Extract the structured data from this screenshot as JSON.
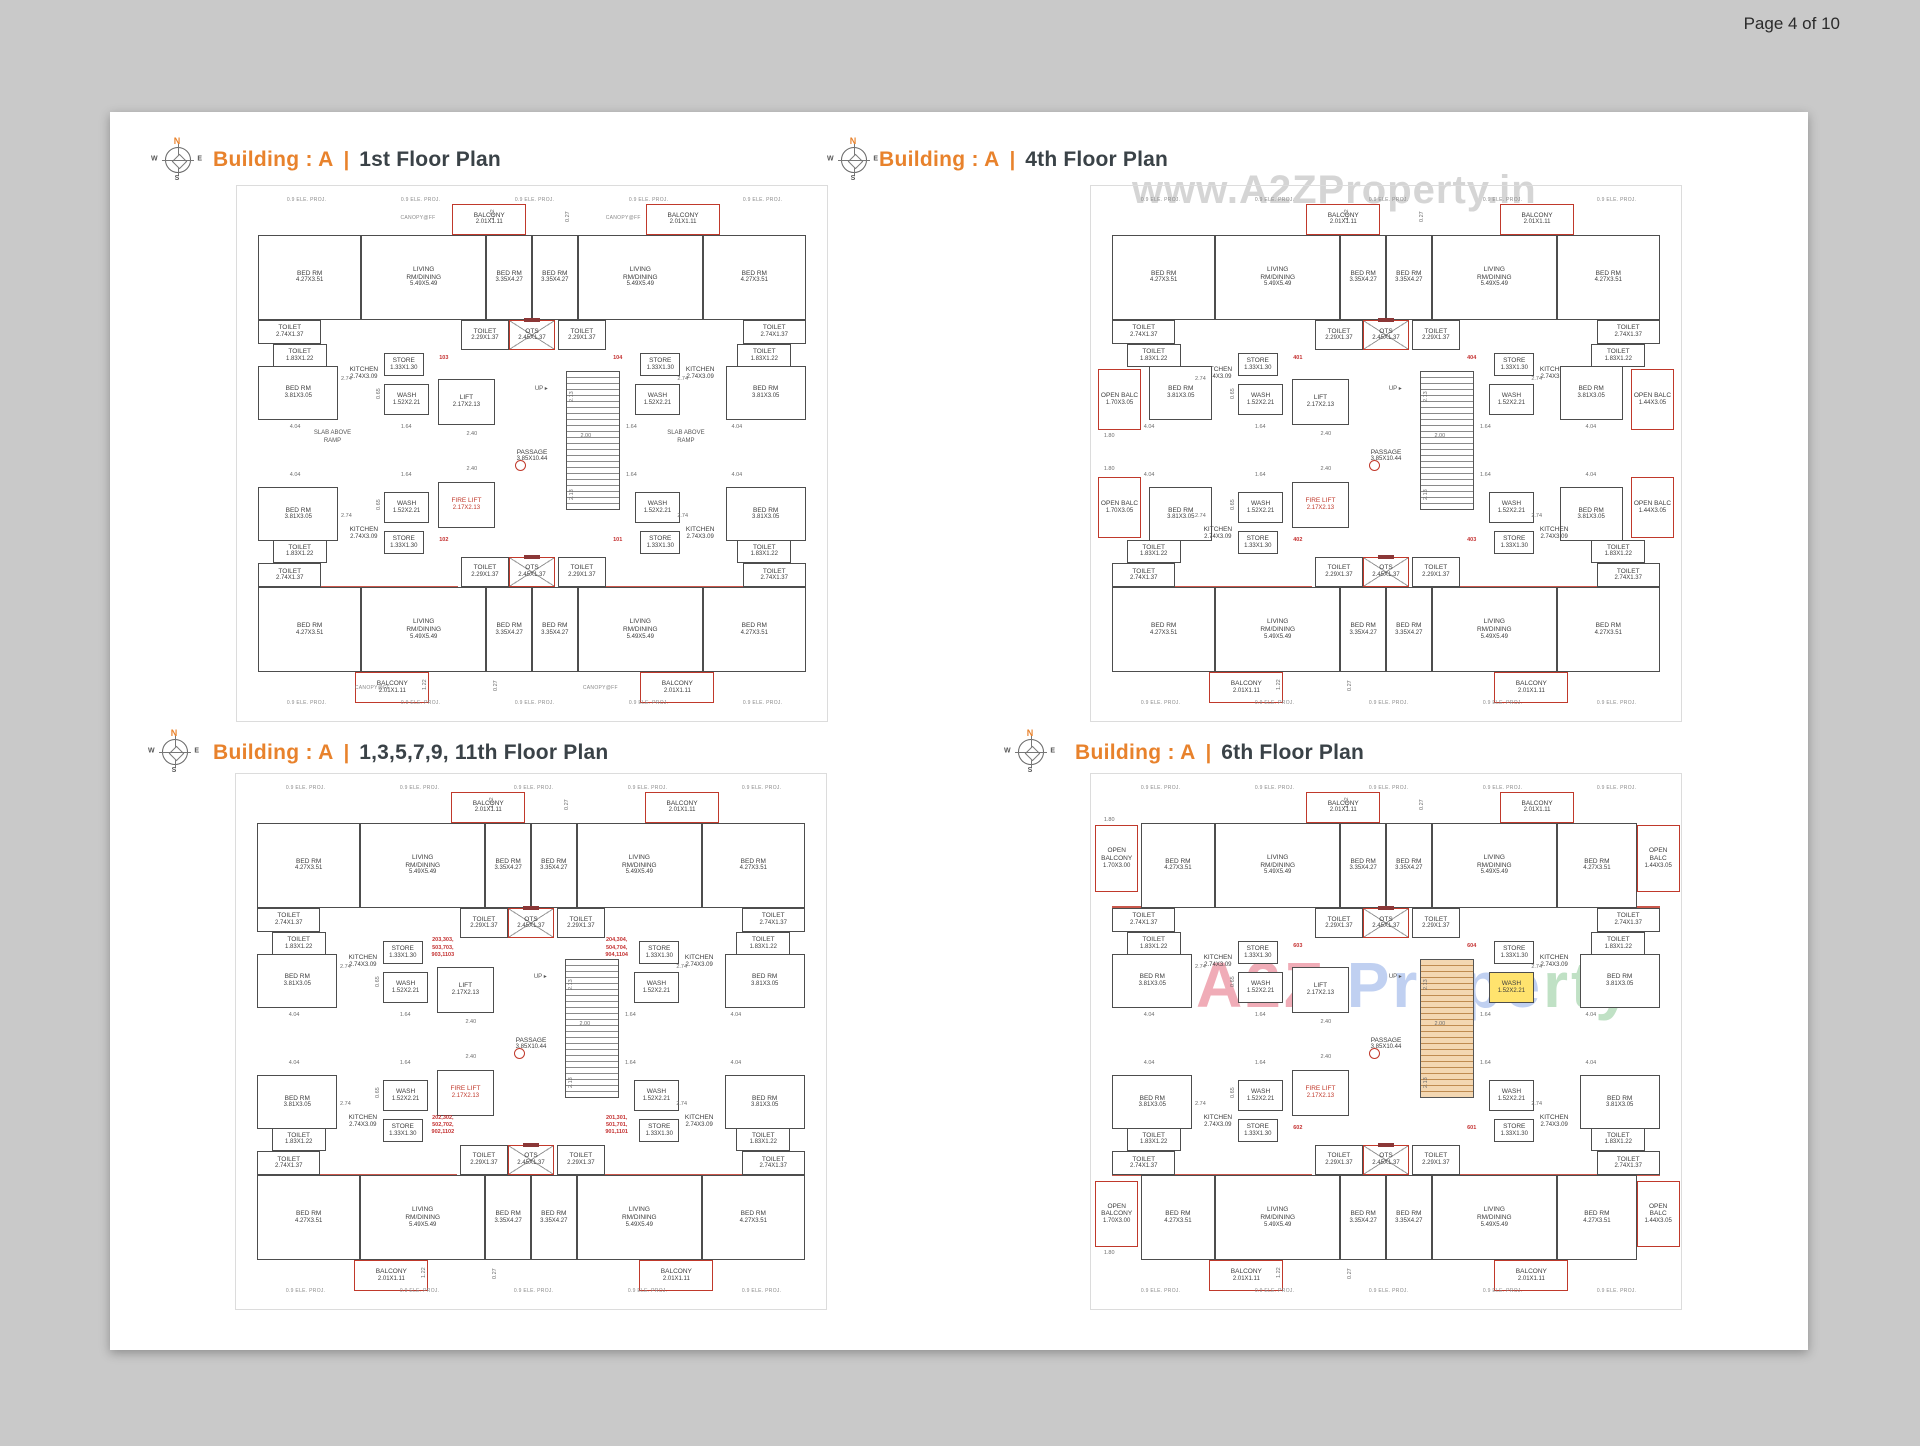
{
  "page": {
    "number_label": "Page 4 of 10"
  },
  "compass": {
    "n": "N",
    "e": "E",
    "s": "S",
    "w": "W"
  },
  "watermark_top": "www.A2ZProperty.in",
  "watermark_brand": {
    "a2z": "A2Z ",
    "prope": "Prope",
    "rty": "rty"
  },
  "shared": {
    "proj_label": "0.9 ELE. PROJ.",
    "proj_positions": [
      [
        7,
        0.2
      ],
      [
        27,
        0.2
      ],
      [
        47,
        0.2
      ],
      [
        67,
        0.2
      ],
      [
        87,
        0.2
      ],
      [
        7,
        97.9
      ],
      [
        27,
        97.9
      ],
      [
        47,
        97.9
      ],
      [
        67,
        97.9
      ],
      [
        87,
        97.9
      ]
    ],
    "up_label": "UP ▸",
    "up_pos": [
      50.5,
      36.8
    ],
    "markers": [
      [
        47,
        51.2
      ]
    ],
    "red_walls": [
      [
        2,
        23.6,
        35
      ],
      [
        63,
        23.6,
        35
      ],
      [
        2,
        75.7,
        35
      ],
      [
        63,
        75.7,
        35
      ]
    ],
    "dims": [
      {
        "t": "2.74",
        "x": 16.5,
        "y": 34.9
      },
      {
        "t": "2.74",
        "x": 75.5,
        "y": 34.9
      },
      {
        "t": "2.74",
        "x": 16.5,
        "y": 61.6
      },
      {
        "t": "2.74",
        "x": 75.5,
        "y": 61.6
      },
      {
        "t": "1.64",
        "x": 27,
        "y": 44.3
      },
      {
        "t": "1.64",
        "x": 66.5,
        "y": 44.3
      },
      {
        "t": "1.64",
        "x": 27,
        "y": 53.6
      },
      {
        "t": "1.64",
        "x": 66.5,
        "y": 53.6
      },
      {
        "t": "2.40",
        "x": 38.5,
        "y": 45.6
      },
      {
        "t": "2.40",
        "x": 38.5,
        "y": 52.4
      },
      {
        "t": "2.00",
        "x": 58.5,
        "y": 46
      },
      {
        "t": "4.04",
        "x": 7.5,
        "y": 44.3
      },
      {
        "t": "4.04",
        "x": 85,
        "y": 44.3
      },
      {
        "t": "4.04",
        "x": 7.5,
        "y": 53.6
      },
      {
        "t": "4.04",
        "x": 85,
        "y": 53.6
      },
      {
        "t": "2.13",
        "x": 56.5,
        "y": 40,
        "v": 1
      },
      {
        "t": "2.13",
        "x": 56.5,
        "y": 59,
        "v": 1
      },
      {
        "t": "1.22",
        "x": 42.7,
        "y": 4.6,
        "v": 1
      },
      {
        "t": "1.22",
        "x": 30.7,
        "y": 96,
        "v": 1
      },
      {
        "t": "0.27",
        "x": 55.8,
        "y": 5,
        "v": 1
      },
      {
        "t": "0.27",
        "x": 43.2,
        "y": 96.2,
        "v": 1
      },
      {
        "t": "0.65",
        "x": 22.6,
        "y": 39.5,
        "v": 1
      },
      {
        "t": "0.65",
        "x": 22.6,
        "y": 61,
        "v": 1
      }
    ]
  },
  "base_rooms": [
    {
      "id": "balc_t1",
      "label": "BALCONY",
      "dim": "2.01X1.11",
      "x": 36,
      "y": 1.5,
      "w": 13,
      "h": 6,
      "cls": "red"
    },
    {
      "id": "balc_t2",
      "label": "BALCONY",
      "dim": "2.01X1.11",
      "x": 70,
      "y": 1.5,
      "w": 13,
      "h": 6,
      "cls": "red"
    },
    {
      "id": "bed_tl",
      "label": "BED RM",
      "dim": "4.27X3.51",
      "x": 2,
      "y": 7.5,
      "w": 18,
      "h": 16.5
    },
    {
      "id": "liv_tl",
      "label": "LIVING\nRM/DINING",
      "dim": "5.49X5.49",
      "x": 20,
      "y": 7.5,
      "w": 22,
      "h": 16.5
    },
    {
      "id": "bed_tm1",
      "label": "BED RM",
      "dim": "3.35X4.27",
      "x": 42,
      "y": 7.5,
      "w": 8,
      "h": 16.5
    },
    {
      "id": "bed_tm2",
      "label": "BED RM",
      "dim": "3.35X4.27",
      "x": 50,
      "y": 7.5,
      "w": 8,
      "h": 16.5
    },
    {
      "id": "liv_tr",
      "label": "LIVING\nRM/DINING",
      "dim": "5.49X5.49",
      "x": 58,
      "y": 7.5,
      "w": 22,
      "h": 16.5
    },
    {
      "id": "bed_tr",
      "label": "BED RM",
      "dim": "4.27X3.51",
      "x": 80,
      "y": 7.5,
      "w": 18,
      "h": 16.5
    },
    {
      "id": "wc_tl1",
      "label": "TOILET",
      "dim": "2.74X1.37",
      "x": 2,
      "y": 24,
      "w": 11,
      "h": 4.8
    },
    {
      "id": "wc_tl2",
      "label": "TOILET",
      "dim": "1.83X1.22",
      "x": 4.5,
      "y": 28.8,
      "w": 9.5,
      "h": 4.5
    },
    {
      "id": "wc_ct1",
      "label": "TOILET",
      "dim": "2.29X1.37",
      "x": 37.5,
      "y": 24,
      "w": 8.5,
      "h": 6
    },
    {
      "id": "ots_t",
      "label": "OTS",
      "dim": "2.45X1.37",
      "x": 46,
      "y": 24,
      "w": 8,
      "h": 6,
      "cls": "ots"
    },
    {
      "id": "wc_ct2",
      "label": "TOILET",
      "dim": "2.29X1.37",
      "x": 54.5,
      "y": 24,
      "w": 8.5,
      "h": 6
    },
    {
      "id": "wc_tr2",
      "label": "TOILET",
      "dim": "1.83X1.22",
      "x": 86,
      "y": 28.8,
      "w": 9.5,
      "h": 4.5
    },
    {
      "id": "wc_tr1",
      "label": "TOILET",
      "dim": "2.74X1.37",
      "x": 87,
      "y": 24,
      "w": 11,
      "h": 4.8
    },
    {
      "id": "store_tl",
      "label": "STORE",
      "dim": "1.33X1.30",
      "x": 24,
      "y": 30.5,
      "w": 7,
      "h": 4.5
    },
    {
      "id": "store_tr",
      "label": "STORE",
      "dim": "1.33X1.30",
      "x": 69,
      "y": 30.5,
      "w": 7,
      "h": 4.5
    },
    {
      "id": "kit_tl",
      "label": "KITCHEN",
      "dim": "2.74X3.09",
      "x": 15.5,
      "y": 31.5,
      "w": 10,
      "h": 6,
      "cls": "open"
    },
    {
      "id": "kit_tr",
      "label": "KITCHEN",
      "dim": "2.74X3.09",
      "x": 74.5,
      "y": 31.5,
      "w": 10,
      "h": 6,
      "cls": "open"
    },
    {
      "id": "bed_ml",
      "label": "BED RM",
      "dim": "3.81X3.05",
      "x": 2,
      "y": 33,
      "w": 14,
      "h": 10.5
    },
    {
      "id": "bed_mr",
      "label": "BED RM",
      "dim": "3.81X3.05",
      "x": 84,
      "y": 33,
      "w": 14,
      "h": 10.5
    },
    {
      "id": "wash_tl",
      "label": "WASH",
      "dim": "1.52X2.21",
      "x": 24,
      "y": 36.5,
      "w": 8,
      "h": 6
    },
    {
      "id": "wash_tr",
      "label": "WASH",
      "dim": "1.52X2.21",
      "x": 68,
      "y": 36.5,
      "w": 8,
      "h": 6
    },
    {
      "id": "lift",
      "label": "LIFT",
      "dim": "2.17X2.13",
      "x": 33.5,
      "y": 35.5,
      "w": 10,
      "h": 9
    },
    {
      "id": "stairs",
      "label": "",
      "dim": "",
      "x": 56,
      "y": 34,
      "w": 9.5,
      "h": 27,
      "cls": "stairs"
    },
    {
      "id": "passage",
      "label": "PASSAGE",
      "dim": "3.85X10.44",
      "x": 44,
      "y": 47,
      "w": 12,
      "h": 7,
      "cls": "open"
    },
    {
      "id": "firelift",
      "label": "FIRE LIFT",
      "dim": "2.17X2.13",
      "x": 33.5,
      "y": 55.5,
      "w": 10,
      "h": 9,
      "cls": "redtext"
    },
    {
      "id": "wash_bl",
      "label": "WASH",
      "dim": "1.52X2.21",
      "x": 24,
      "y": 57.5,
      "w": 8,
      "h": 6
    },
    {
      "id": "wash_br",
      "label": "WASH",
      "dim": "1.52X2.21",
      "x": 68,
      "y": 57.5,
      "w": 8,
      "h": 6
    },
    {
      "id": "bed_ll",
      "label": "BED RM",
      "dim": "3.81X3.05",
      "x": 2,
      "y": 56.5,
      "w": 14,
      "h": 10.5
    },
    {
      "id": "bed_lr",
      "label": "BED RM",
      "dim": "3.81X3.05",
      "x": 84,
      "y": 56.5,
      "w": 14,
      "h": 10.5
    },
    {
      "id": "kit_bl",
      "label": "KITCHEN",
      "dim": "2.74X3.09",
      "x": 15.5,
      "y": 62.5,
      "w": 10,
      "h": 6,
      "cls": "open"
    },
    {
      "id": "kit_br",
      "label": "KITCHEN",
      "dim": "2.74X3.09",
      "x": 74.5,
      "y": 62.5,
      "w": 10,
      "h": 6,
      "cls": "open"
    },
    {
      "id": "store_bl",
      "label": "STORE",
      "dim": "1.33X1.30",
      "x": 24,
      "y": 65,
      "w": 7,
      "h": 4.5
    },
    {
      "id": "store_br",
      "label": "STORE",
      "dim": "1.33X1.30",
      "x": 69,
      "y": 65,
      "w": 7,
      "h": 4.5
    },
    {
      "id": "wc_cb1",
      "label": "TOILET",
      "dim": "2.29X1.37",
      "x": 37.5,
      "y": 70,
      "w": 8.5,
      "h": 6
    },
    {
      "id": "ots_b",
      "label": "OTS",
      "dim": "2.45X1.37",
      "x": 46,
      "y": 70,
      "w": 8,
      "h": 6,
      "cls": "ots"
    },
    {
      "id": "wc_cb2",
      "label": "TOILET",
      "dim": "2.29X1.37",
      "x": 54.5,
      "y": 70,
      "w": 8.5,
      "h": 6
    },
    {
      "id": "wc_bl2",
      "label": "TOILET",
      "dim": "1.83X1.22",
      "x": 4.5,
      "y": 66.7,
      "w": 9.5,
      "h": 4.5
    },
    {
      "id": "wc_bl1",
      "label": "TOILET",
      "dim": "2.74X1.37",
      "x": 2,
      "y": 71.2,
      "w": 11,
      "h": 4.8
    },
    {
      "id": "wc_br2",
      "label": "TOILET",
      "dim": "1.83X1.22",
      "x": 86,
      "y": 66.7,
      "w": 9.5,
      "h": 4.5
    },
    {
      "id": "wc_br1",
      "label": "TOILET",
      "dim": "2.74X1.37",
      "x": 87,
      "y": 71.2,
      "w": 11,
      "h": 4.8
    },
    {
      "id": "bed_bl",
      "label": "BED RM",
      "dim": "4.27X3.51",
      "x": 2,
      "y": 76,
      "w": 18,
      "h": 16.5
    },
    {
      "id": "liv_bl",
      "label": "LIVING\nRM/DINING",
      "dim": "5.49X5.49",
      "x": 20,
      "y": 76,
      "w": 22,
      "h": 16.5
    },
    {
      "id": "bed_bm1",
      "label": "BED RM",
      "dim": "3.35X4.27",
      "x": 42,
      "y": 76,
      "w": 8,
      "h": 16.5
    },
    {
      "id": "bed_bm2",
      "label": "BED RM",
      "dim": "3.35X4.27",
      "x": 50,
      "y": 76,
      "w": 8,
      "h": 16.5
    },
    {
      "id": "liv_br",
      "label": "LIVING\nRM/DINING",
      "dim": "5.49X5.49",
      "x": 58,
      "y": 76,
      "w": 22,
      "h": 16.5
    },
    {
      "id": "bed_br",
      "label": "BED RM",
      "dim": "4.27X3.51",
      "x": 80,
      "y": 76,
      "w": 18,
      "h": 16.5
    },
    {
      "id": "balc_b1",
      "label": "BALCONY",
      "dim": "2.01X1.11",
      "x": 19,
      "y": 92.5,
      "w": 13,
      "h": 6,
      "cls": "red"
    },
    {
      "id": "balc_b2",
      "label": "BALCONY",
      "dim": "2.01X1.11",
      "x": 69,
      "y": 92.5,
      "w": 13,
      "h": 6,
      "cls": "red"
    }
  ],
  "plans": [
    {
      "building_label": "Building : A",
      "sep": "|",
      "floor_label": "1st Floor Plan",
      "units": [
        {
          "t": "103",
          "x": 30.5,
          "y": 30.8
        },
        {
          "t": "104",
          "x": 61,
          "y": 30.8
        },
        {
          "t": "102",
          "x": 30.5,
          "y": 66.3
        },
        {
          "t": "101",
          "x": 61,
          "y": 66.3
        }
      ],
      "labels": [
        {
          "t": "SLAB ABOVE\nRAMP",
          "x": 8,
          "y": 45.5,
          "w": 14
        },
        {
          "t": "SLAB ABOVE\nRAMP",
          "x": 70,
          "y": 45.5,
          "w": 14
        },
        {
          "t": "CANOPY@FF",
          "x": 25,
          "y": 3.6,
          "w": 10,
          "cls": "proj"
        },
        {
          "t": "CANOPY@FF",
          "x": 61,
          "y": 3.6,
          "w": 10,
          "cls": "proj"
        },
        {
          "t": "CANOPY@FF",
          "x": 17,
          "y": 95,
          "w": 10,
          "cls": "proj"
        },
        {
          "t": "CANOPY@FF",
          "x": 57,
          "y": 95,
          "w": 10,
          "cls": "proj"
        }
      ],
      "extras": [],
      "overrides": []
    },
    {
      "building_label": "Building : A",
      "sep": "|",
      "floor_label": "4th Floor Plan",
      "units": [
        {
          "t": "401",
          "x": 30.5,
          "y": 30.8
        },
        {
          "t": "404",
          "x": 61,
          "y": 30.8
        },
        {
          "t": "402",
          "x": 30.5,
          "y": 66.3
        },
        {
          "t": "403",
          "x": 61,
          "y": 66.3
        }
      ],
      "labels": [
        {
          "t": "1.80",
          "x": 0.5,
          "y": 46,
          "cls": "dim"
        },
        {
          "t": "1.80",
          "x": 0.5,
          "y": 52.5,
          "cls": "dim"
        }
      ],
      "extras": [
        {
          "id": "obal_l1",
          "label": "OPEN BALC",
          "dim": "1.70X3.05",
          "x": -0.5,
          "y": 33.5,
          "w": 7.5,
          "h": 12,
          "cls": "red"
        },
        {
          "id": "obal_l2",
          "label": "OPEN BALC",
          "dim": "1.70X3.05",
          "x": -0.5,
          "y": 54.5,
          "w": 7.5,
          "h": 12,
          "cls": "red"
        },
        {
          "id": "obal_r1",
          "label": "OPEN BALC",
          "dim": "1.44X3.05",
          "x": 93,
          "y": 33.5,
          "w": 7.5,
          "h": 12,
          "cls": "red"
        },
        {
          "id": "obal_r2",
          "label": "OPEN BALC",
          "dim": "1.44X3.05",
          "x": 93,
          "y": 54.5,
          "w": 7.5,
          "h": 12,
          "cls": "red"
        }
      ],
      "overrides": [
        {
          "id": "bed_ml",
          "x": 8.5,
          "w": 11
        },
        {
          "id": "bed_mr",
          "x": 80.5,
          "w": 11
        },
        {
          "id": "bed_ll",
          "x": 8.5,
          "w": 11
        },
        {
          "id": "bed_lr",
          "x": 80.5,
          "w": 11
        }
      ]
    },
    {
      "building_label": "Building : A",
      "sep": "|",
      "floor_label": "1,3,5,7,9, 11th Floor Plan",
      "units": [
        {
          "t": "203,303,\n503,703,\n903,1103",
          "x": 30.5,
          "y": 29.8
        },
        {
          "t": "204,304,\n504,704,\n904,1104",
          "x": 61,
          "y": 29.8
        },
        {
          "t": "202,302,\n502,702,\n902,1102",
          "x": 30.5,
          "y": 64.3
        },
        {
          "t": "201,301,\n501,701,\n901,1101",
          "x": 61,
          "y": 64.3
        }
      ],
      "labels": [],
      "extras": [],
      "overrides": []
    },
    {
      "building_label": "Building : A",
      "sep": "|",
      "floor_label": "6th Floor Plan",
      "units": [
        {
          "t": "603",
          "x": 30.5,
          "y": 30.8
        },
        {
          "t": "604",
          "x": 61,
          "y": 30.8
        },
        {
          "t": "602",
          "x": 30.5,
          "y": 66.3
        },
        {
          "t": "601",
          "x": 61,
          "y": 66.3
        }
      ],
      "labels": [
        {
          "t": "1.80",
          "x": 0.5,
          "y": 6.5,
          "cls": "dim"
        },
        {
          "t": "1.80",
          "x": 0.5,
          "y": 90.5,
          "cls": "dim"
        }
      ],
      "extras": [
        {
          "id": "obal_lt",
          "label": "OPEN\nBALCONY",
          "dim": "1.70X3.00",
          "x": -1,
          "y": 8,
          "w": 7.5,
          "h": 13,
          "cls": "red"
        },
        {
          "id": "obal_lb",
          "label": "OPEN\nBALCONY",
          "dim": "1.70X3.00",
          "x": -1,
          "y": 77,
          "w": 7.5,
          "h": 13,
          "cls": "red"
        },
        {
          "id": "obal_rt",
          "label": "OPEN\nBALC",
          "dim": "1.44X3.05",
          "x": 94,
          "y": 8,
          "w": 7.5,
          "h": 13,
          "cls": "red"
        },
        {
          "id": "obal_rb",
          "label": "OPEN\nBALC",
          "dim": "1.44X3.05",
          "x": 94,
          "y": 77,
          "w": 7.5,
          "h": 13,
          "cls": "red"
        }
      ],
      "overrides": [
        {
          "id": "bed_tl",
          "x": 7,
          "w": 13
        },
        {
          "id": "bed_bl",
          "x": 7,
          "w": 13
        },
        {
          "id": "bed_tr",
          "x": 80,
          "w": 14
        },
        {
          "id": "bed_br",
          "x": 80,
          "w": 14
        },
        {
          "id": "wash_tr",
          "cls": "yellow"
        },
        {
          "id": "stairs",
          "cls": "stairs orange"
        }
      ]
    }
  ]
}
